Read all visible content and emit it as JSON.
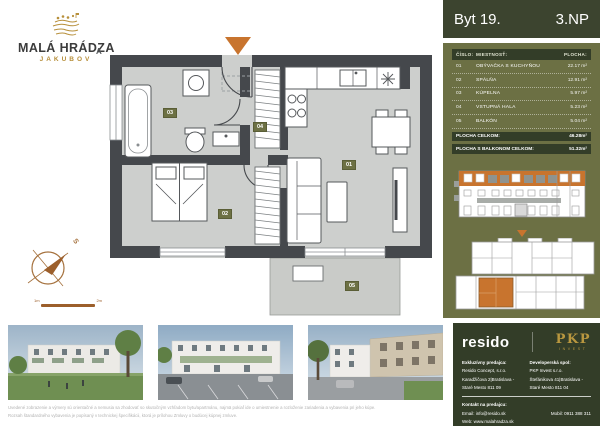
{
  "colors": {
    "olive": "#6c7044",
    "dark_green": "#333d28",
    "header_green": "#3c442f",
    "orange": "#c8742e",
    "gold": "#b78f3a",
    "wall_gray": "#45484c",
    "floor_gray": "#cdcfcd"
  },
  "logo": {
    "title": "MALÁ HRÁDZA",
    "subtitle": "JAKUBOV",
    "icon": "hills-sheep-logo-icon"
  },
  "header": {
    "unit": "Byt 19.",
    "floor": "3.NP"
  },
  "room_table": {
    "col_number": "ČÍSLO:",
    "col_room": "MIESTNOSŤ:",
    "col_area": "PLOCHA:",
    "rows": [
      {
        "number": "01",
        "room": "OBÝVAČKA S KUCHYŇOU",
        "area": "22.17 m²"
      },
      {
        "number": "02",
        "room": "SPÁLŇA",
        "area": "12.91 m²"
      },
      {
        "number": "03",
        "room": "KÚPELNA",
        "area": "5.97 m²"
      },
      {
        "number": "04",
        "room": "VSTUPNÁ HALA",
        "area": "5.23 m²"
      },
      {
        "number": "05",
        "room": "BALKÓN",
        "area": "5.04 m²"
      }
    ],
    "totals": [
      {
        "label": "PLOCHA CELKOM:",
        "value": "46.28m²"
      },
      {
        "label": "PLOCHA S BALKONOM CELKOM:",
        "value": "51.32m²"
      }
    ]
  },
  "floor_plan": {
    "section_marker": "A",
    "labels": {
      "r01": "01",
      "r02": "02",
      "r03": "03",
      "r04": "04",
      "r05": "05"
    },
    "compass_label": "S",
    "scale": {
      "start": "1m",
      "end": "2m"
    }
  },
  "diagrams": {
    "elevation": "building-front-elevation-3np-highlighted",
    "overview": "floor-overview-unit-highlighted"
  },
  "photos": [
    "exterior-rendering-garden",
    "exterior-rendering-parking",
    "exterior-rendering-street"
  ],
  "disclaimer": {
    "line1": "Uvedené zobrazenie a výmery sú orientačné a nemusia sa zhodovať so skutočným vzhľadom bytu/apartmánu, najmä pokiaľ ide o umiestnenie a rozloženie zariadenia a vybavenia pri jeho kúpe.",
    "line2": "Rozsah štandardného vybavenia je popísaný v technickej špecifikácii, ktorá je prílohou Zmluvy o budúcej kúpnej zmluve."
  },
  "footer": {
    "brand_left": "resido",
    "brand_right": "PKP",
    "brand_right_sub": "INVEST",
    "seller_heading": "Exkluzívny predajca:",
    "seller_lines": [
      "Resido Concept, s.r.o.",
      "Karadžičova 2|Bratislava -",
      "Staré Mesto 811 09"
    ],
    "developer_heading": "Developerská spol:",
    "developer_lines": [
      "PKP Invest s.r.o.",
      "Štefánikova 41|Bratislava -",
      "Staré Mesto 811 04"
    ],
    "contact_heading": "Kontakt na predajcu:",
    "email": "Email: info@resido.sk",
    "web": "Web: www.malahradza.sk",
    "mobile": "Mobil: 0911 388 311"
  }
}
